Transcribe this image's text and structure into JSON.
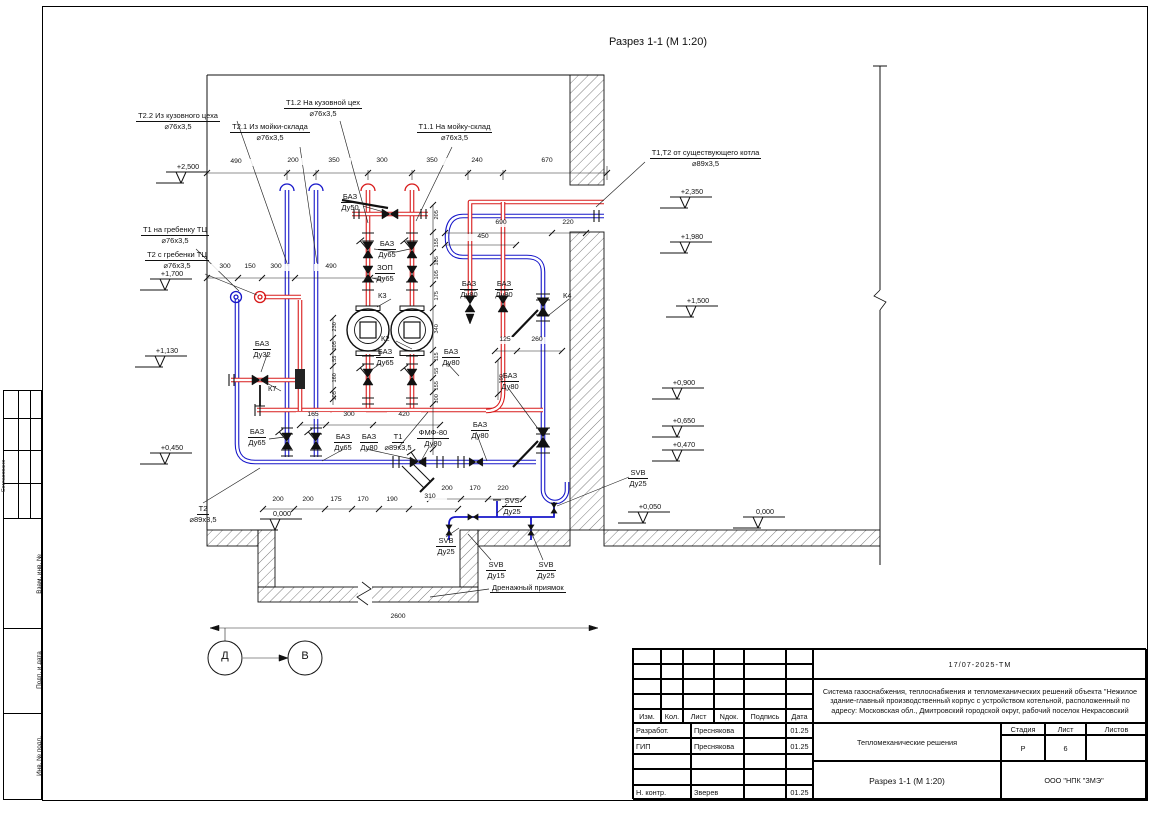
{
  "sheet": {
    "view_title": "Разрез 1-1 (М 1:20)",
    "axis_left": "Д",
    "axis_right": "В",
    "drain_pit_label": "Дренажный приямок"
  },
  "colors": {
    "pipe_red": "#d81a1a",
    "pipe_blue": "#1717c9"
  },
  "callouts": [
    {
      "l1": "Т2.2 Из кузовного цеха",
      "l2": "⌀76х3,5"
    },
    {
      "l1": "Т2.1 Из мойки-склада",
      "l2": "⌀76х3,5"
    },
    {
      "l1": "Т1.2 На кузовной цех",
      "l2": "⌀76х3,5"
    },
    {
      "l1": "Т1.1 На мойку-склад",
      "l2": "⌀76х3,5"
    },
    {
      "l1": "Т1,Т2 от существующего котла",
      "l2": "⌀89х3,5"
    },
    {
      "l1": "Т1 на гребенку ТЦ",
      "l2": "⌀76х3,5"
    },
    {
      "l1": "Т2 с гребенки ТЦ",
      "l2": "⌀76х3,5"
    },
    {
      "l1": "БАЗ",
      "l2": "Ду50"
    },
    {
      "l1": "БАЗ",
      "l2": "Ду65"
    },
    {
      "l1": "ЗОП",
      "l2": "Ду65"
    },
    {
      "l1": "БАЗ",
      "l2": "Ду80"
    },
    {
      "l1": "БАЗ",
      "l2": "Ду80"
    },
    {
      "l1": "БАЗ",
      "l2": "Ду32"
    },
    {
      "l1": "БАЗ",
      "l2": "Ду65"
    },
    {
      "l1": "БАЗ",
      "l2": "Ду65"
    },
    {
      "l1": "БАЗ",
      "l2": "Ду80"
    },
    {
      "l1": "Т1",
      "l2": "⌀89х3,5"
    },
    {
      "l1": "ФМФ-80",
      "l2": "Ду80"
    },
    {
      "l1": "БАЗ",
      "l2": "Ду65"
    },
    {
      "l1": "БАЗ",
      "l2": "Ду80"
    },
    {
      "l1": "БАЗ",
      "l2": "Ду80"
    },
    {
      "l1": "БАЗ",
      "l2": "Ду80"
    },
    {
      "l1": "SVS",
      "l2": "Ду25"
    },
    {
      "l1": "SVB",
      "l2": "Ду25"
    },
    {
      "l1": "SVB",
      "l2": "Ду15"
    },
    {
      "l1": "SVB",
      "l2": "Ду25"
    },
    {
      "l1": "SVB",
      "l2": "Ду25"
    },
    {
      "l1": "Т2",
      "l2": "⌀89х3,5"
    }
  ],
  "tags": [
    {
      "t": "К3"
    },
    {
      "t": "К2"
    },
    {
      "t": "К4"
    },
    {
      "t": "К7"
    }
  ],
  "elevations": [
    {
      "v": "+2,500"
    },
    {
      "v": "+1,700"
    },
    {
      "v": "+1,130"
    },
    {
      "v": "+0,450"
    },
    {
      "v": "0,000"
    },
    {
      "v": "+2,350"
    },
    {
      "v": "+1,980"
    },
    {
      "v": "+1,500"
    },
    {
      "v": "+0,900"
    },
    {
      "v": "+0,650"
    },
    {
      "v": "+0,470"
    },
    {
      "v": "+0,050"
    },
    {
      "v": "0,000"
    }
  ],
  "dims": [
    {
      "t": "490"
    },
    {
      "t": "200"
    },
    {
      "t": "350"
    },
    {
      "t": "300"
    },
    {
      "t": "350"
    },
    {
      "t": "240"
    },
    {
      "t": "670"
    },
    {
      "t": "300"
    },
    {
      "t": "150"
    },
    {
      "t": "300"
    },
    {
      "t": "490"
    },
    {
      "t": "690"
    },
    {
      "t": "450"
    },
    {
      "t": "220"
    },
    {
      "t": "125"
    },
    {
      "t": "260"
    },
    {
      "t": "165"
    },
    {
      "t": "300"
    },
    {
      "t": "420"
    },
    {
      "t": "200"
    },
    {
      "t": "200"
    },
    {
      "t": "175"
    },
    {
      "t": "170"
    },
    {
      "t": "190"
    },
    {
      "t": "310"
    },
    {
      "t": "200"
    },
    {
      "t": "170"
    },
    {
      "t": "220"
    },
    {
      "t": "2600"
    }
  ],
  "vdims": [
    {
      "t": "205"
    },
    {
      "t": "155"
    },
    {
      "t": "105"
    },
    {
      "t": "105"
    },
    {
      "t": "175"
    },
    {
      "t": "340"
    },
    {
      "t": "115"
    },
    {
      "t": "55"
    },
    {
      "t": "155"
    },
    {
      "t": "100"
    },
    {
      "t": "230"
    },
    {
      "t": "105"
    },
    {
      "t": "55"
    },
    {
      "t": "160"
    },
    {
      "t": "105"
    },
    {
      "t": "190"
    }
  ],
  "sidebar": {
    "approval": "Согласовано",
    "cells": [
      {
        "label": "Взам. инв. №"
      },
      {
        "label": "Подп. и дата"
      },
      {
        "label": "Инв. № подл."
      }
    ]
  },
  "title_block": {
    "doc_number": "17/07-2025-ТМ",
    "description": "Система газоснабжения, теплоснабжения и тепломеханических решений объекта \"Нежилое здание-главный производственный корпус с устройством котельной, расположенный по адресу: Московская обл., Дмитровский городской округ, рабочий поселок Некрасовский",
    "project_title": "Тепломеханические решения",
    "view_ref": "Разрез 1-1 (М 1:20)",
    "company": "ООО \"НПК \"ЗМЭ\"",
    "stage_label": "Стадия",
    "sheet_label": "Лист",
    "sheets_label": "Листов",
    "stage": "Р",
    "sheet_no": "6",
    "sheets_total": "",
    "header": [
      {
        "t": "Изм."
      },
      {
        "t": "Кол."
      },
      {
        "t": "Лист"
      },
      {
        "t": "Nдок."
      },
      {
        "t": "Подпись"
      },
      {
        "t": "Дата"
      }
    ],
    "rows": [
      {
        "role": "Разработ.",
        "name": "Преснякова",
        "sign": "",
        "date": "01.25"
      },
      {
        "role": "ГИП",
        "name": "Преснякова",
        "sign": "",
        "date": "01.25"
      },
      {
        "role": "",
        "name": "",
        "sign": "",
        "date": ""
      },
      {
        "role": "",
        "name": "",
        "sign": "",
        "date": ""
      },
      {
        "role": "Н. контр.",
        "name": "Зверев",
        "sign": "",
        "date": "01.25"
      }
    ]
  }
}
